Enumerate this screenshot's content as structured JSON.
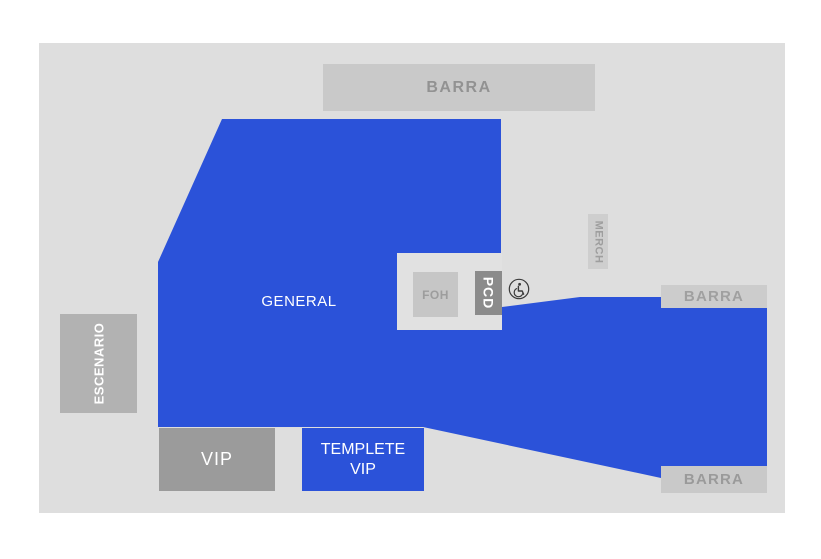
{
  "colors": {
    "accent_blue": "#2b52d9",
    "floor_gray": "#dedede",
    "bar_gray": "#c9c9c9",
    "vip_gray": "#9b9b9b",
    "pcd_gray": "#8b8b8b",
    "stage_gray": "#b2b2b2",
    "merch_gray": "#cecece",
    "bar_text_gray": "#929292",
    "zone_text_white": "#ffffff"
  },
  "zones": {
    "barra_top": {
      "label": "BARRA"
    },
    "barra_right": {
      "label": "BARRA"
    },
    "barra_bottom_right": {
      "label": "BARRA"
    },
    "general": {
      "label": "GENERAL"
    },
    "escenario": {
      "label": "ESCENARIO"
    },
    "foh": {
      "label": "FOH"
    },
    "pcd": {
      "label": "PCD"
    },
    "merch": {
      "label": "MERCH"
    },
    "vip": {
      "label": "VIP"
    },
    "templete_vip": {
      "label": "TEMPLETE VIP"
    }
  },
  "icons": {
    "accessible": "wheelchair-icon"
  }
}
